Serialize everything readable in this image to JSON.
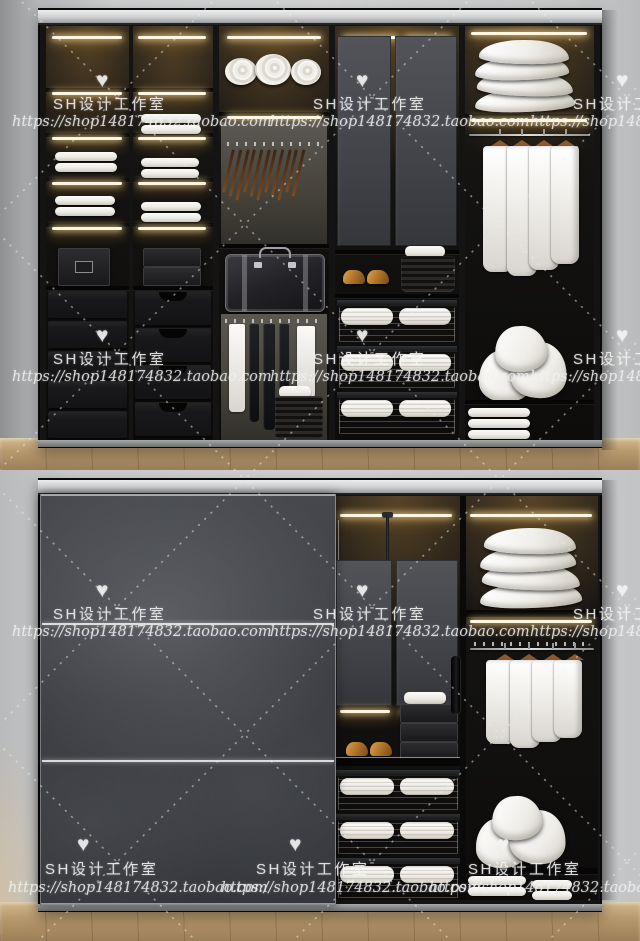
{
  "watermark": {
    "heart": "♥",
    "studio_name": "SH设计工作室",
    "shop_url": "https://shop148174832.taobao.com"
  },
  "colors": {
    "wall": "#c9cacb",
    "wardrobe_frame": "#141414",
    "door_gray": "#3c3e43",
    "led_warm_white": "#fff6e2",
    "linen_white": "#d8d5cf",
    "wood_floor": "#b99a6f",
    "shoe_tan": "#a96f26",
    "hanger_wood": "#8a5a30",
    "watermark_white": "#eeeeee"
  }
}
